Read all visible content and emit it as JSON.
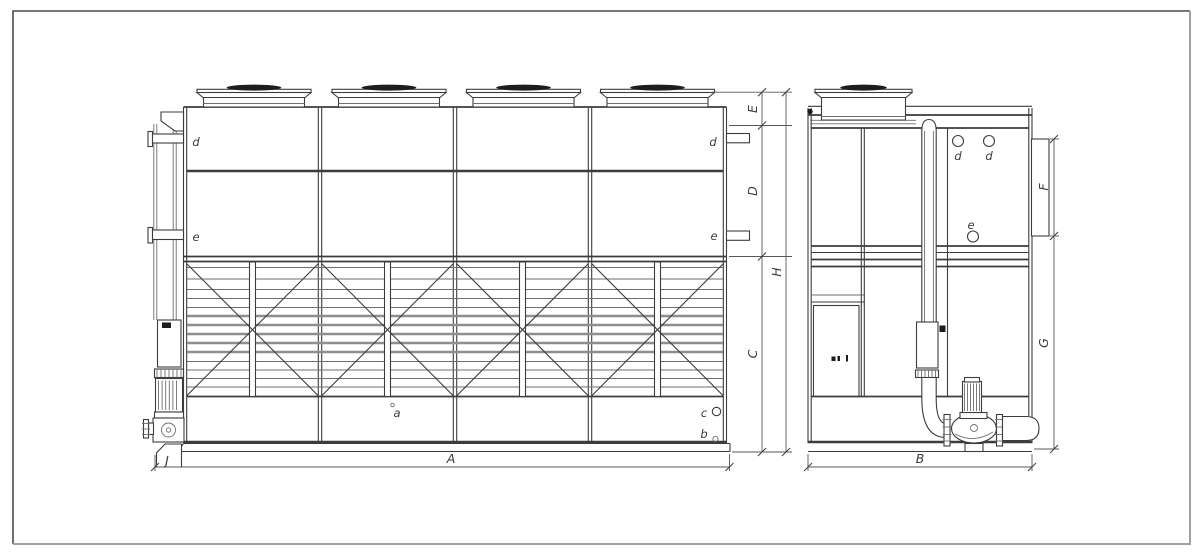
{
  "drawing": {
    "description": "Two-view engineering outline drawing of a closed-circuit cooling tower with four fan units, inlet/outlet connections, louver section, basin and circulation pumps",
    "front_view": {
      "part_labels": {
        "d_left": "d",
        "e_left": "e",
        "d_right": "d",
        "e_right": "e",
        "a": "a",
        "b": "b",
        "c": "c"
      },
      "dim_labels": {
        "A": "A",
        "C": "C",
        "D": "D",
        "E": "E",
        "H": "H",
        "J": "J"
      }
    },
    "side_view": {
      "part_labels": {
        "d1": "d",
        "d2": "d",
        "e": "e"
      },
      "dim_labels": {
        "B": "B",
        "F": "F",
        "G": "G"
      }
    },
    "colors": {
      "background": "#ffffff",
      "line_primary": "#3c3c3c",
      "line_soft": "#6e6e6e",
      "louver_gray": "#8e8e8e",
      "fill": "#ffffff",
      "dark_fill": "#1d1d1d",
      "dim": "#585858",
      "border_dark": "#4b4b4b",
      "border_light": "#a0a0a0",
      "text": "#3a3a3a"
    }
  }
}
